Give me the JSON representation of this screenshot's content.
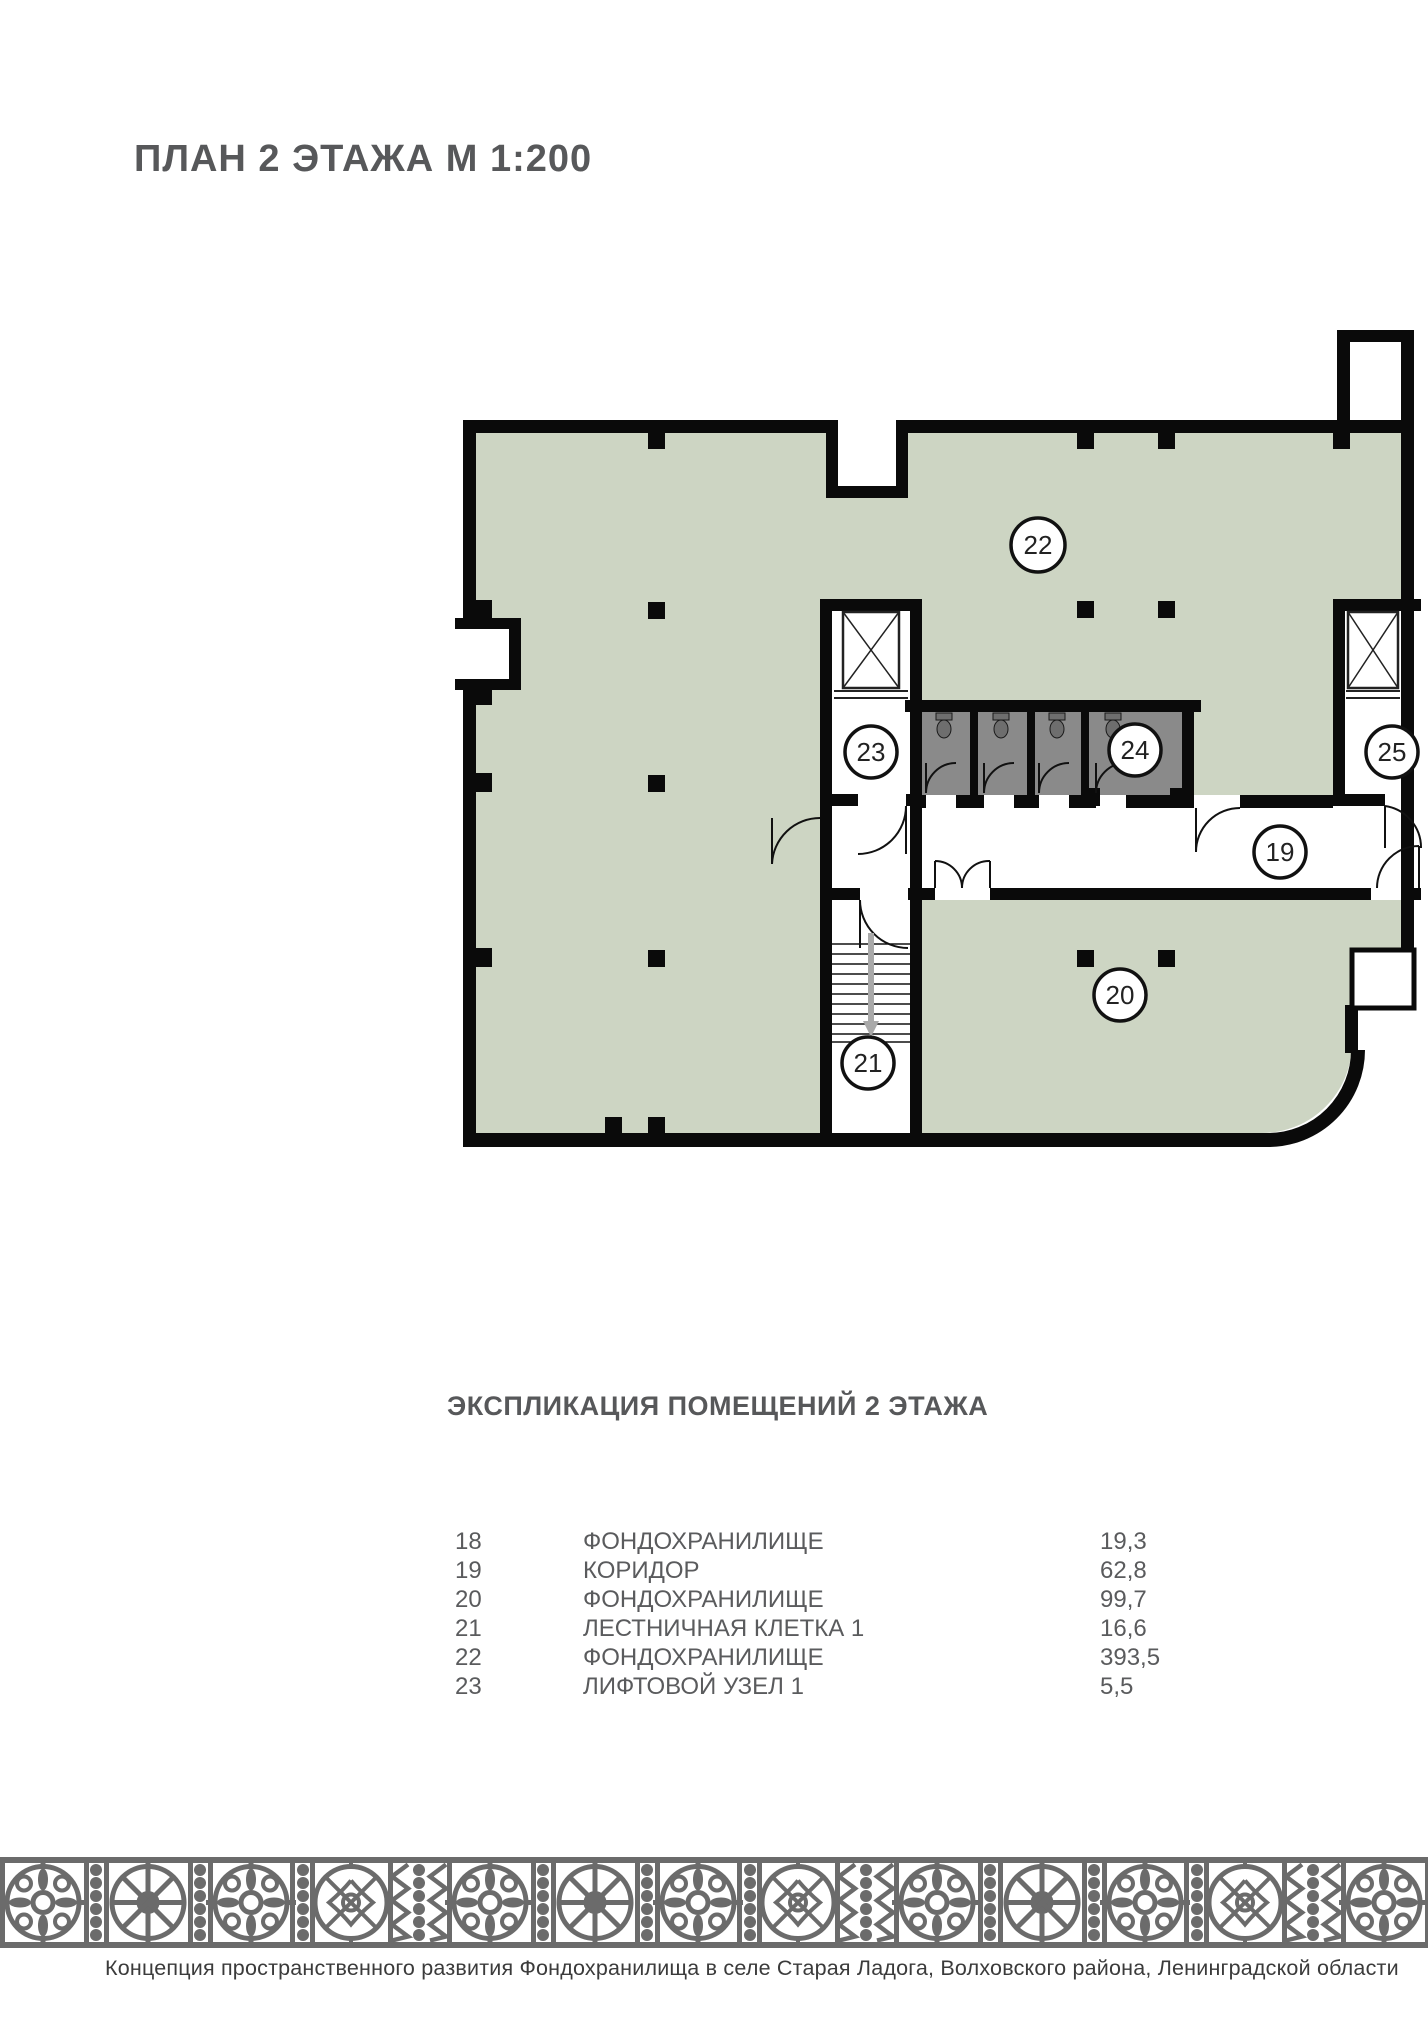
{
  "page": {
    "title": "ПЛАН 2 ЭТАЖА М 1:200"
  },
  "plan": {
    "rooms": {
      "r19": "19",
      "r20": "20",
      "r21": "21",
      "r22": "22",
      "r23": "23",
      "r24": "24",
      "r25": "25"
    },
    "colors": {
      "room_fill": "#cdd5c3",
      "wc_fill": "#8a8a8a",
      "wall": "#0a0a0a",
      "stair_arrow": "#a9a9a9"
    }
  },
  "explication": {
    "title": "ЭКСПЛИКАЦИЯ ПОМЕЩЕНИЙ 2 ЭТАЖА",
    "rows": [
      {
        "num": "18",
        "name": "ФОНДОХРАНИЛИЩЕ",
        "area": "19,3"
      },
      {
        "num": "19",
        "name": "КОРИДОР",
        "area": "62,8"
      },
      {
        "num": "20",
        "name": "ФОНДОХРАНИЛИЩЕ",
        "area": "99,7"
      },
      {
        "num": "21",
        "name": "ЛЕСТНИЧНАЯ КЛЕТКА 1",
        "area": "16,6"
      },
      {
        "num": "22",
        "name": "ФОНДОХРАНИЛИЩЕ",
        "area": "393,5"
      },
      {
        "num": "23",
        "name": "ЛИФТОВОЙ УЗЕЛ 1",
        "area": "5,5"
      }
    ]
  },
  "footer": {
    "caption": "Концепция пространственного развития Фондохранилища в селе Старая Ладога, Волховского района, Ленинградской области"
  }
}
